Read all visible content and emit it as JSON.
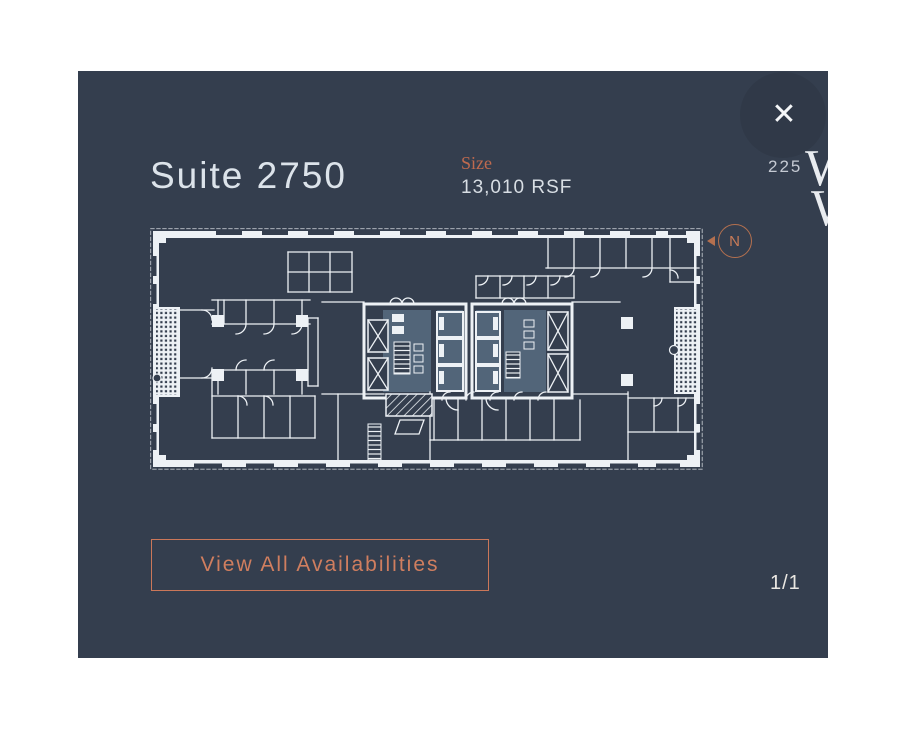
{
  "colors": {
    "page_background": "#ffffff",
    "modal_background": "#343e4e",
    "plan_line": "#edf1f5",
    "plan_core_fill": "#526579",
    "accent_orange": "#cb7759"
  },
  "header": {
    "title": "Suite 2750",
    "size_label": "Size",
    "size_value": "13,010 RSF"
  },
  "logo": {
    "prefix": "225",
    "line1_letter": "W",
    "line2_letter": "W"
  },
  "icons": {
    "close": "✕"
  },
  "compass": {
    "label": "N"
  },
  "floorplan": {
    "name": "Suite 2750 floor plan"
  },
  "footer": {
    "button_label": "View All Availabilities",
    "pagination": "1/1"
  }
}
